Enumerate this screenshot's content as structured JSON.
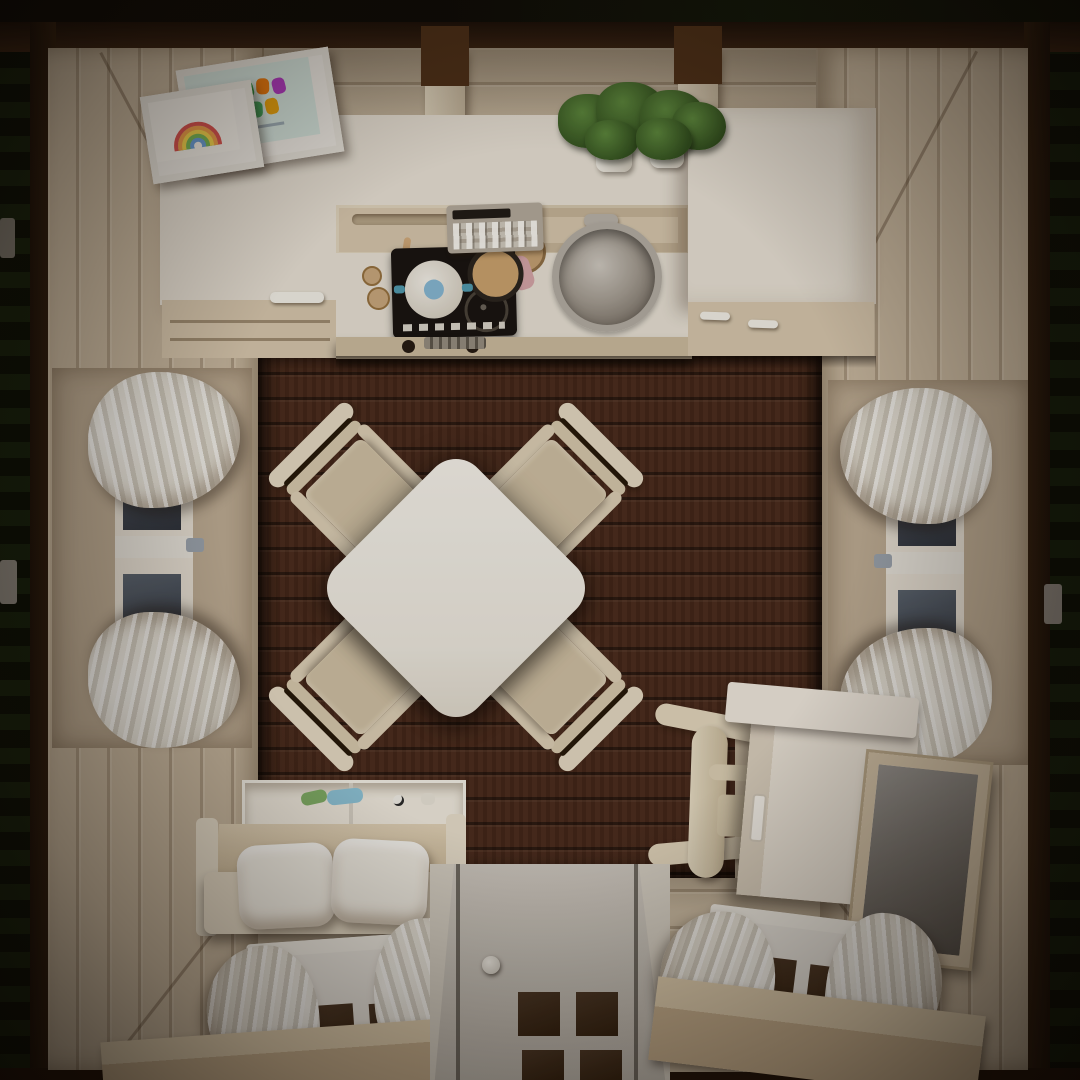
{
  "labels": {
    "scene": "Top-down 3D render of a cozy tiny-house room interior",
    "exterior": "Dark timber roof edge with foliage outside",
    "floor": "Dark walnut plank floor",
    "wall_top": "Cream plank wall (kitchen side)",
    "wall_left": "Cream panelled wall, left",
    "wall_right": "Cream panelled wall, right",
    "wall_bottom": "Cream plank wall (entry side)",
    "kitchen": "Kitchenette counter with cabinets",
    "cooktop": "Black cooktop with white pot and frying pan",
    "control_panel": "Counter appliance control panel",
    "sink": "Round stainless-steel sink with faucet",
    "plants": "Potted green plants on the counter",
    "fridge_cabinet": "Tall white cabinet unit",
    "frame_rainbow": "Framed rainbow drawing",
    "frame_letters": "Framed colorful lettering artwork",
    "table": "White square dining table (rotated 45 degrees)",
    "chair": "Cream wooden dining chair",
    "window_left": "Left window with tied white curtains",
    "window_right": "Right window with tied white curtains",
    "sofa": "Bench sofa with two white pillows",
    "toybox": "Storage compartment with toys behind sofa",
    "desk": "White desk with drawer",
    "desk_chair": "Cream desk chair",
    "mirror": "Wall mirror in wooden frame",
    "door": "Entry door with glass panes and round knob",
    "window_bottom_left": "Bottom-left window with curtains",
    "window_bottom_right": "Bottom-right window with curtains",
    "window_bench": "Window-side bench",
    "ceiling_beam": "Ceiling rafter beam",
    "hinge": "Exterior wall hinge"
  },
  "palette": {
    "floor": "#46281a",
    "wall": "#c9baa2",
    "counter": "#e7e1d5",
    "cabinet": "#d6c7ae",
    "cooktop": "#171310",
    "plant_green": "#41682c",
    "curtain": "#efece5",
    "door": "#ccc7bf",
    "pot_lid_blue": "#86b8d4",
    "pan_handle_pink": "#d5a5a9",
    "toy_green": "#7fae66",
    "toy_blue": "#8cc3d8",
    "mirror_glass": "#6f6d69",
    "exterior_wood": "#2c1a0e"
  }
}
